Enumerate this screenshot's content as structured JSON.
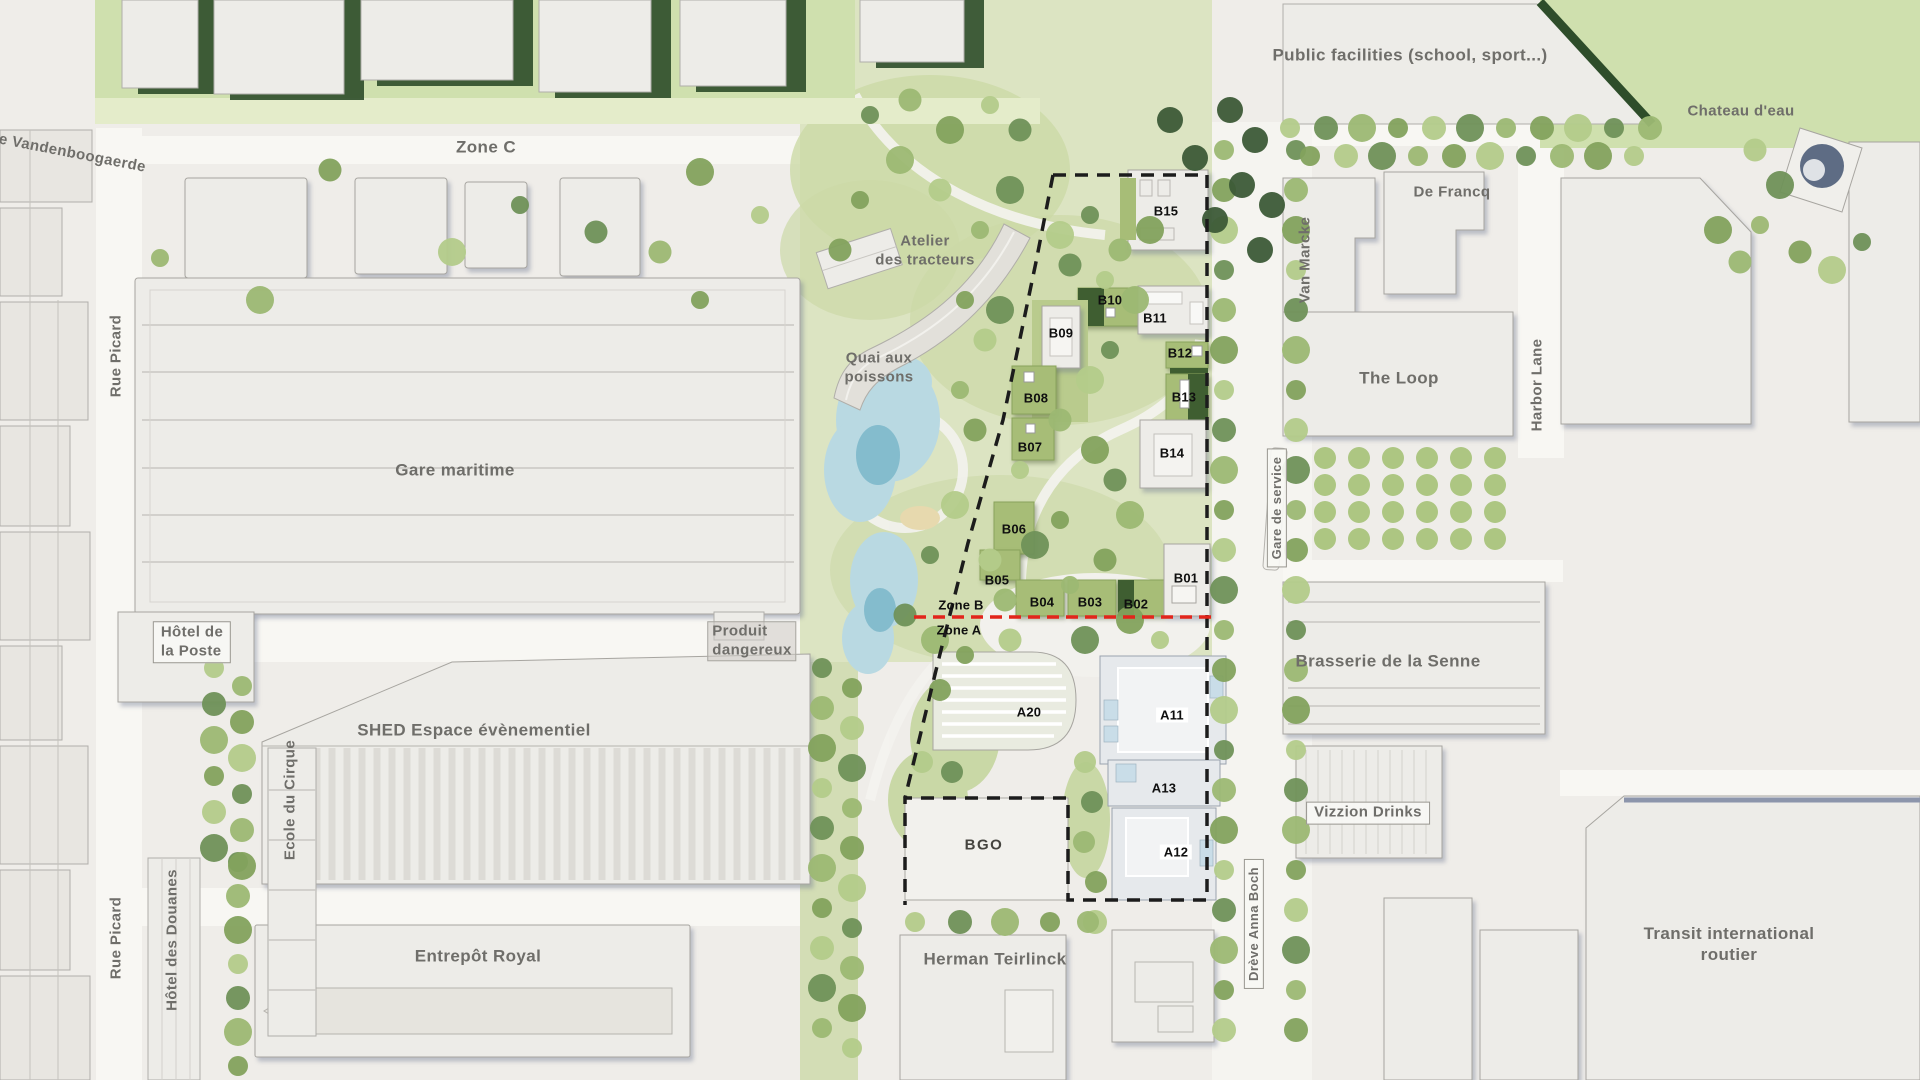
{
  "map_title": "Masterplan site map",
  "zones": {
    "zone_a": "Zone A",
    "zone_b": "Zone B",
    "zone_c": "Zone C"
  },
  "streets": {
    "rue_vandenboogaerde": "Rue Vandenboogaerde",
    "rue_picard": "Rue Picard",
    "harbor_lane": "Harbor Lane",
    "dreve_anna_boch": "Drève Anna Boch",
    "gare_de_service": "Gare de service"
  },
  "places": {
    "public_facilities": "Public facilities (school, sport...)",
    "chateau_deau": "Chateau d'eau",
    "de_francq": "De Francq",
    "van_marcke": "Van Marcke",
    "the_loop": "The Loop",
    "atelier_des_tracteurs": "Atelier\ndes tracteurs",
    "quai_aux_poissons": "Quai aux\npoissons",
    "gare_maritime": "Gare maritime",
    "hotel_de_la_poste": "Hôtel de\nla Poste",
    "produit_dangereux": "Produit\ndangereux",
    "shed": "SHED Espace évènementiel",
    "ecole_du_cirque": "Ecole du Cirque",
    "hotel_des_douanes": "Hôtel des Douanes",
    "entrepot_royal": "Entrepôt Royal",
    "herman_teirlinck": "Herman Teirlinck",
    "brasserie": "Brasserie de la Senne",
    "vizzion_drinks": "Vizzion Drinks",
    "transit": "Transit international routier",
    "bgo": "BGO"
  },
  "building_codes": {
    "b01": "B01",
    "b02": "B02",
    "b03": "B03",
    "b04": "B04",
    "b05": "B05",
    "b06": "B06",
    "b07": "B07",
    "b08": "B08",
    "b09": "B09",
    "b10": "B10",
    "b11": "B11",
    "b12": "B12",
    "b13": "B13",
    "b14": "B14",
    "b15": "B15",
    "a11": "A11",
    "a12": "A12",
    "a13": "A13",
    "a20": "A20"
  },
  "colors": {
    "boundary": "#1c1c1c",
    "zone_divider": "#e2251b",
    "water": "#b9d9e2",
    "park_green": "#dce4c2",
    "roof_green": "#a7bd77",
    "building": "#edece8"
  }
}
